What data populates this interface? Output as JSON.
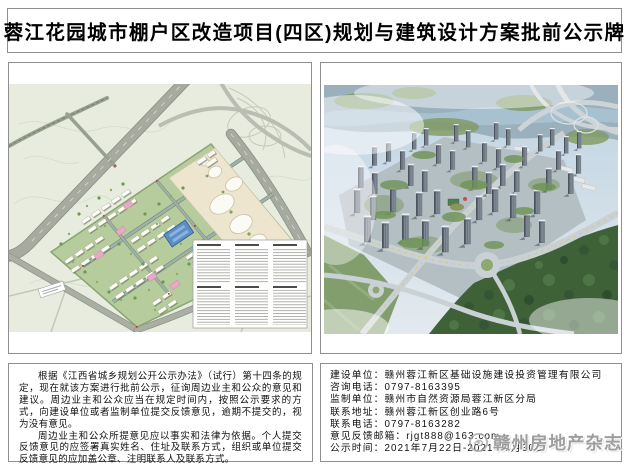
{
  "title": "蓉江花园城市棚户区改造项目(四区)规划与建筑设计方案批前公示牌",
  "notice": {
    "paragraph1": "根据《江西省城乡规划公开公示办法》（试行）第十四条的规定，现在就该方案进行批前公示，征询周边业主和公众的意见和建议。周边业主和公众应当在规定时间内，按照公示要求的方式，向建设单位或者监制单位提交反馈意见，逾期不提交的，视为没有意见。",
    "paragraph2": "周边业主和公众所提意见应以事实和法律为依据。个人提交反馈意见的应签署真实姓名、住址及联系方式，组织或单位提交反馈意见的应加盖公章、注明联系人及联系方式。"
  },
  "contact": {
    "lines": [
      "建设单位：赣州蓉江新区基础设施建设投资管理有限公司",
      "咨询电话：0797-8163395",
      "监制单位：赣州市自然资源局蓉江新区分局",
      "联系地址：赣州蓉江新区创业路6号",
      "联系电话：0797-8163282",
      "意见反馈邮箱：rjgt888@163.com",
      "公示时间：2021年7月22日-2021年7月30日"
    ]
  },
  "watermark": {
    "text": "赣州房地产杂志"
  },
  "icons": {
    "watermark_logo": "magazine-logo-icon"
  },
  "colors": {
    "frame_border": "#8f8f8f",
    "plan_background": "#e7ecdf",
    "plan_road": "#a6aa9f",
    "plan_block_green": "#b7cc9c",
    "render_sky": "#bfd3e2",
    "render_forest": "#3f6138",
    "watermark_gray": "#9e9e9e"
  }
}
